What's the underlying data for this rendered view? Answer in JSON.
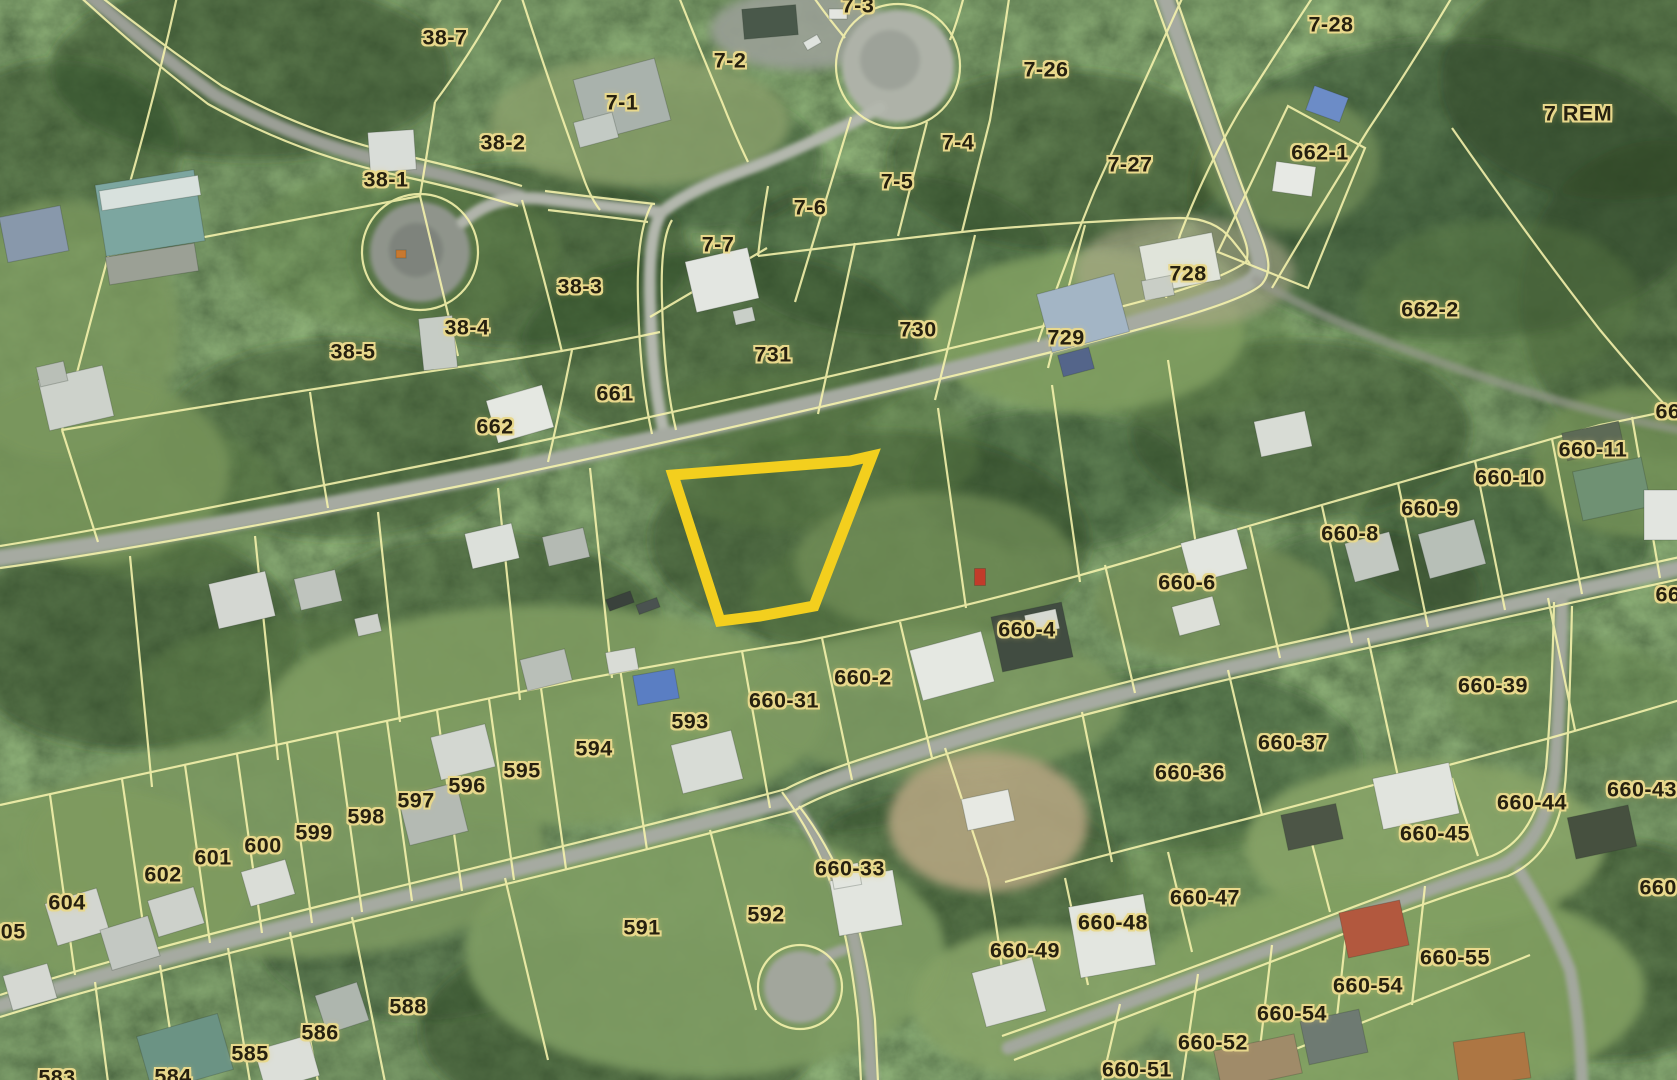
{
  "map": {
    "colors": {
      "highlight": "#f3cf1e",
      "parcel_line": "#f8f4ad",
      "label_text": "#26200f",
      "label_halo": "#e8d88c",
      "road": "#a3a79d"
    },
    "highlight": {
      "stroke_width": 11,
      "points": [
        [
          673,
          475
        ],
        [
          850,
          461
        ],
        [
          872,
          456
        ],
        [
          814,
          606
        ],
        [
          760,
          616
        ],
        [
          720,
          621
        ]
      ]
    },
    "labels": [
      {
        "text": "38-7",
        "x": 445,
        "y": 38
      },
      {
        "text": "7-3",
        "x": 858,
        "y": 6
      },
      {
        "text": "7-2",
        "x": 730,
        "y": 61
      },
      {
        "text": "7-26",
        "x": 1046,
        "y": 70
      },
      {
        "text": "7-28",
        "x": 1331,
        "y": 25
      },
      {
        "text": "7 REM",
        "x": 1578,
        "y": 114
      },
      {
        "text": "7-1",
        "x": 622,
        "y": 103
      },
      {
        "text": "38-2",
        "x": 503,
        "y": 143
      },
      {
        "text": "38-1",
        "x": 386,
        "y": 180
      },
      {
        "text": "7-4",
        "x": 958,
        "y": 143
      },
      {
        "text": "7-5",
        "x": 897,
        "y": 182
      },
      {
        "text": "7-6",
        "x": 810,
        "y": 208
      },
      {
        "text": "7-27",
        "x": 1130,
        "y": 165
      },
      {
        "text": "662-1",
        "x": 1320,
        "y": 153
      },
      {
        "text": "662-2",
        "x": 1430,
        "y": 310
      },
      {
        "text": "728",
        "x": 1188,
        "y": 274
      },
      {
        "text": "729",
        "x": 1066,
        "y": 338
      },
      {
        "text": "730",
        "x": 918,
        "y": 330
      },
      {
        "text": "731",
        "x": 773,
        "y": 355
      },
      {
        "text": "7-7",
        "x": 718,
        "y": 245
      },
      {
        "text": "38-3",
        "x": 580,
        "y": 287
      },
      {
        "text": "38-4",
        "x": 467,
        "y": 328
      },
      {
        "text": "38-5",
        "x": 353,
        "y": 352
      },
      {
        "text": "661",
        "x": 615,
        "y": 394
      },
      {
        "text": "662",
        "x": 495,
        "y": 427
      },
      {
        "text": "660-11",
        "x": 1593,
        "y": 450
      },
      {
        "text": "660-10",
        "x": 1510,
        "y": 478
      },
      {
        "text": "660-9",
        "x": 1430,
        "y": 509
      },
      {
        "text": "660-8",
        "x": 1350,
        "y": 534
      },
      {
        "text": "660-6",
        "x": 1187,
        "y": 583
      },
      {
        "text": "660-4",
        "x": 1027,
        "y": 630
      },
      {
        "text": "660-2",
        "x": 863,
        "y": 678
      },
      {
        "text": "660-31",
        "x": 784,
        "y": 701
      },
      {
        "text": "593",
        "x": 690,
        "y": 722
      },
      {
        "text": "594",
        "x": 594,
        "y": 749
      },
      {
        "text": "595",
        "x": 522,
        "y": 771
      },
      {
        "text": "596",
        "x": 467,
        "y": 786
      },
      {
        "text": "597",
        "x": 416,
        "y": 801
      },
      {
        "text": "598",
        "x": 366,
        "y": 817
      },
      {
        "text": "599",
        "x": 314,
        "y": 833
      },
      {
        "text": "600",
        "x": 263,
        "y": 846
      },
      {
        "text": "601",
        "x": 213,
        "y": 858
      },
      {
        "text": "602",
        "x": 163,
        "y": 875
      },
      {
        "text": "604",
        "x": 67,
        "y": 903
      },
      {
        "text": "605",
        "x": 7,
        "y": 932
      },
      {
        "text": "588",
        "x": 408,
        "y": 1007
      },
      {
        "text": "586",
        "x": 320,
        "y": 1033
      },
      {
        "text": "585",
        "x": 250,
        "y": 1054
      },
      {
        "text": "584",
        "x": 173,
        "y": 1077
      },
      {
        "text": "583",
        "x": 57,
        "y": 1078
      },
      {
        "text": "591",
        "x": 642,
        "y": 928
      },
      {
        "text": "592",
        "x": 766,
        "y": 915
      },
      {
        "text": "660-33",
        "x": 850,
        "y": 869
      },
      {
        "text": "660-39",
        "x": 1493,
        "y": 686
      },
      {
        "text": "660-37",
        "x": 1293,
        "y": 743
      },
      {
        "text": "660-36",
        "x": 1190,
        "y": 773
      },
      {
        "text": "660-44",
        "x": 1532,
        "y": 803
      },
      {
        "text": "660-45",
        "x": 1435,
        "y": 834
      },
      {
        "text": "660-43",
        "x": 1642,
        "y": 790
      },
      {
        "text": "660-47",
        "x": 1205,
        "y": 898
      },
      {
        "text": "660-48",
        "x": 1113,
        "y": 923
      },
      {
        "text": "660-49",
        "x": 1025,
        "y": 951
      },
      {
        "text": "660-55",
        "x": 1455,
        "y": 958
      },
      {
        "text": "660-54",
        "x": 1368,
        "y": 986
      },
      {
        "text": "660-54",
        "x": 1292,
        "y": 1014
      },
      {
        "text": "660-52",
        "x": 1213,
        "y": 1043
      },
      {
        "text": "660-51",
        "x": 1137,
        "y": 1070
      },
      {
        "text": "66",
        "x": 1668,
        "y": 412
      },
      {
        "text": "66",
        "x": 1668,
        "y": 595
      },
      {
        "text": "660-",
        "x": 1662,
        "y": 888
      }
    ]
  }
}
